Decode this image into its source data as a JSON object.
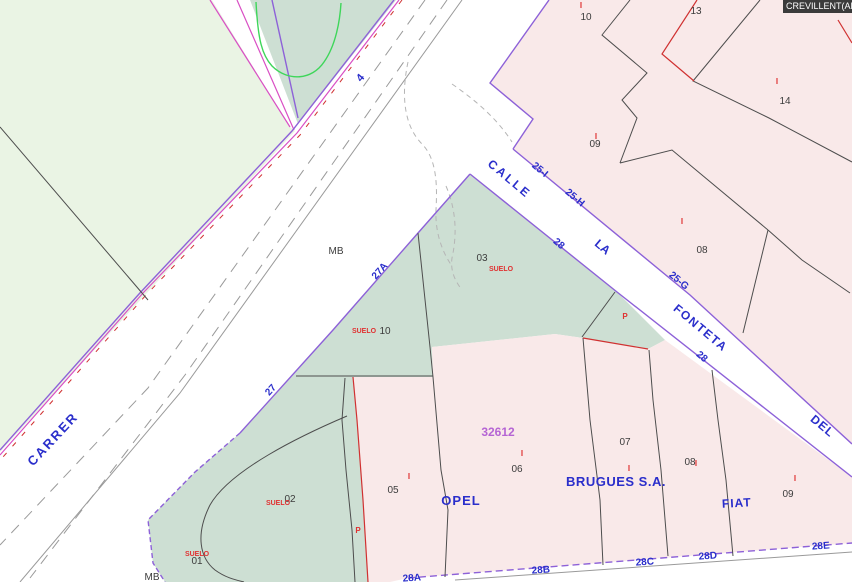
{
  "corner": {
    "title": "CREVILLENT(ALI"
  },
  "colors": {
    "field_green": "#eaf4e4",
    "parcel_green": "#cddfd3",
    "parcel_pink": "#f9e9e9",
    "boundary_dark": "#4d4d4d",
    "boundary_purple": "#8d61d8",
    "boundary_magenta": "#d94fc4",
    "boundary_red": "#d03131",
    "road_gray": "#9a9a9a",
    "label_blue": "#2a2ecb",
    "label_red": "#e03131",
    "label_purple": "#b564d4",
    "label_dark": "#3c3c3c"
  },
  "map": {
    "labels": [
      {
        "name": "street-label-carrer",
        "text": "CARRER",
        "x": 56,
        "y": 442,
        "rot": -47,
        "size": 13,
        "cls": "blue",
        "ls": 2
      },
      {
        "name": "road-number-4",
        "text": "4",
        "x": 363,
        "y": 80,
        "rot": -50,
        "size": 11,
        "cls": "blue"
      },
      {
        "name": "street-label-calle",
        "text": "CALLE",
        "x": 507,
        "y": 182,
        "rot": 40,
        "size": 12,
        "cls": "blue",
        "ls": 2.5
      },
      {
        "name": "house-number-25i",
        "text": "25-I",
        "x": 538,
        "y": 172,
        "rot": 40,
        "size": 10,
        "cls": "blue"
      },
      {
        "name": "house-number-25h",
        "text": "25-H",
        "x": 573,
        "y": 200,
        "rot": 40,
        "size": 10,
        "cls": "blue"
      },
      {
        "name": "house-number-28-upper",
        "text": "28",
        "x": 557,
        "y": 246,
        "rot": 40,
        "size": 10,
        "cls": "blue"
      },
      {
        "name": "street-label-la",
        "text": "LA",
        "x": 600,
        "y": 250,
        "rot": 40,
        "size": 12,
        "cls": "blue"
      },
      {
        "name": "house-number-25g",
        "text": "25-G",
        "x": 677,
        "y": 283,
        "rot": 40,
        "size": 10,
        "cls": "blue"
      },
      {
        "name": "street-label-fonteta",
        "text": "FONTETA",
        "x": 698,
        "y": 331,
        "rot": 40,
        "size": 12,
        "cls": "blue",
        "ls": 1.5
      },
      {
        "name": "house-number-28-lower",
        "text": "28",
        "x": 700,
        "y": 359,
        "rot": 40,
        "size": 10,
        "cls": "blue"
      },
      {
        "name": "street-label-del",
        "text": "DEL",
        "x": 820,
        "y": 429,
        "rot": 40,
        "size": 12,
        "cls": "blue",
        "ls": 1
      },
      {
        "name": "house-number-27",
        "text": "27",
        "x": 273,
        "y": 392,
        "rot": -48,
        "size": 10,
        "cls": "blue"
      },
      {
        "name": "house-number-27a",
        "text": "27A",
        "x": 382,
        "y": 273,
        "rot": -48,
        "size": 10,
        "cls": "blue"
      },
      {
        "name": "business-label-opel",
        "text": "OPEL",
        "x": 461,
        "y": 505,
        "rot": 0,
        "size": 13,
        "cls": "blue",
        "ls": 1
      },
      {
        "name": "business-label-brugues",
        "text": "BRUGUES S.A.",
        "x": 616,
        "y": 486,
        "rot": 0,
        "size": 13,
        "cls": "blue",
        "ls": 0.5
      },
      {
        "name": "business-label-fiat",
        "text": "FIAT",
        "x": 737,
        "y": 507,
        "rot": -3,
        "size": 12,
        "cls": "blue",
        "ls": 1
      },
      {
        "name": "house-number-28a",
        "text": "28A",
        "x": 412,
        "y": 581,
        "rot": -4,
        "size": 10,
        "cls": "blue"
      },
      {
        "name": "house-number-28b",
        "text": "28B",
        "x": 541,
        "y": 573,
        "rot": -4,
        "size": 10,
        "cls": "blue"
      },
      {
        "name": "house-number-28c",
        "text": "28C",
        "x": 645,
        "y": 565,
        "rot": -4,
        "size": 10,
        "cls": "blue"
      },
      {
        "name": "house-number-28d",
        "text": "28D",
        "x": 708,
        "y": 559,
        "rot": -4,
        "size": 10,
        "cls": "blue"
      },
      {
        "name": "house-number-28e",
        "text": "28E",
        "x": 821,
        "y": 549,
        "rot": -4,
        "size": 10,
        "cls": "blue"
      },
      {
        "name": "parcel-number-10",
        "text": "10",
        "x": 586,
        "y": 20,
        "rot": 0,
        "size": 10,
        "cls": "dark"
      },
      {
        "name": "parcel-number-13",
        "text": "13",
        "x": 696,
        "y": 14,
        "rot": 0,
        "size": 10,
        "cls": "dark"
      },
      {
        "name": "parcel-number-14",
        "text": "14",
        "x": 785,
        "y": 104,
        "rot": 0,
        "size": 10,
        "cls": "dark"
      },
      {
        "name": "parcel-number-09-upper",
        "text": "09",
        "x": 595,
        "y": 147,
        "rot": 0,
        "size": 10,
        "cls": "dark"
      },
      {
        "name": "parcel-number-08-upper",
        "text": "08",
        "x": 702,
        "y": 253,
        "rot": 0,
        "size": 10,
        "cls": "dark"
      },
      {
        "name": "parcel-number-03",
        "text": "03",
        "x": 482,
        "y": 261,
        "rot": 0,
        "size": 10,
        "cls": "dark"
      },
      {
        "name": "map-note-mb-center",
        "text": "MB",
        "x": 336,
        "y": 254,
        "rot": 0,
        "size": 10,
        "cls": "dark"
      },
      {
        "name": "map-note-mb-bottom",
        "text": "MB",
        "x": 152,
        "y": 580,
        "rot": 0,
        "size": 10,
        "cls": "dark"
      },
      {
        "name": "parcel-number-10-suelo",
        "text": "10",
        "x": 385,
        "y": 334,
        "rot": 0,
        "size": 10,
        "cls": "dark"
      },
      {
        "name": "parcel-number-02",
        "text": "02",
        "x": 290,
        "y": 502,
        "rot": 0,
        "size": 10,
        "cls": "dark"
      },
      {
        "name": "parcel-number-01",
        "text": "01",
        "x": 197,
        "y": 564,
        "rot": 0,
        "size": 10,
        "cls": "dark"
      },
      {
        "name": "parcel-number-05",
        "text": "05",
        "x": 393,
        "y": 493,
        "rot": 0,
        "size": 10,
        "cls": "dark"
      },
      {
        "name": "parcel-number-06",
        "text": "06",
        "x": 517,
        "y": 472,
        "rot": 0,
        "size": 10,
        "cls": "dark"
      },
      {
        "name": "parcel-number-07",
        "text": "07",
        "x": 625,
        "y": 445,
        "rot": 0,
        "size": 10,
        "cls": "dark"
      },
      {
        "name": "parcel-number-08-lower",
        "text": "08",
        "x": 690,
        "y": 465,
        "rot": 0,
        "size": 10,
        "cls": "dark"
      },
      {
        "name": "parcel-number-09-lower",
        "text": "09",
        "x": 788,
        "y": 497,
        "rot": 0,
        "size": 10,
        "cls": "dark"
      },
      {
        "name": "suelo-label-03",
        "text": "SUELO",
        "x": 501,
        "y": 271,
        "rot": 0,
        "size": 7,
        "cls": "red"
      },
      {
        "name": "suelo-label-10",
        "text": "SUELO",
        "x": 364,
        "y": 333,
        "rot": 0,
        "size": 7,
        "cls": "red"
      },
      {
        "name": "suelo-label-02",
        "text": "SUELO",
        "x": 278,
        "y": 505,
        "rot": 0,
        "size": 7,
        "cls": "red"
      },
      {
        "name": "suelo-label-01",
        "text": "SUELO",
        "x": 197,
        "y": 556,
        "rot": 0,
        "size": 7,
        "cls": "red"
      },
      {
        "name": "construction-mark-10",
        "text": "I",
        "x": 581,
        "y": 8,
        "rot": 0,
        "size": 8,
        "cls": "red"
      },
      {
        "name": "construction-mark-14",
        "text": "I",
        "x": 777,
        "y": 84,
        "rot": 0,
        "size": 8,
        "cls": "red"
      },
      {
        "name": "construction-mark-09-upper",
        "text": "I",
        "x": 596,
        "y": 139,
        "rot": 0,
        "size": 8,
        "cls": "red"
      },
      {
        "name": "construction-mark-08-upper",
        "text": "I",
        "x": 682,
        "y": 224,
        "rot": 0,
        "size": 8,
        "cls": "red"
      },
      {
        "name": "construction-mark-05",
        "text": "I",
        "x": 409,
        "y": 479,
        "rot": 0,
        "size": 8,
        "cls": "red"
      },
      {
        "name": "construction-mark-06",
        "text": "I",
        "x": 522,
        "y": 456,
        "rot": 0,
        "size": 8,
        "cls": "red"
      },
      {
        "name": "construction-mark-07",
        "text": "I",
        "x": 629,
        "y": 471,
        "rot": 0,
        "size": 8,
        "cls": "red"
      },
      {
        "name": "construction-mark-08-lower",
        "text": "I",
        "x": 696,
        "y": 466,
        "rot": 0,
        "size": 8,
        "cls": "red"
      },
      {
        "name": "construction-mark-09-lower",
        "text": "I",
        "x": 795,
        "y": 481,
        "rot": 0,
        "size": 8,
        "cls": "red"
      },
      {
        "name": "parking-mark-east",
        "text": "P",
        "x": 625,
        "y": 319,
        "rot": 0,
        "size": 8,
        "cls": "red"
      },
      {
        "name": "parking-mark-west",
        "text": "P",
        "x": 358,
        "y": 533,
        "rot": 0,
        "size": 8,
        "cls": "red"
      },
      {
        "name": "cadastral-ref-32612",
        "text": "32612",
        "x": 498,
        "y": 436,
        "rot": 0,
        "size": 12,
        "cls": "purple"
      }
    ]
  }
}
